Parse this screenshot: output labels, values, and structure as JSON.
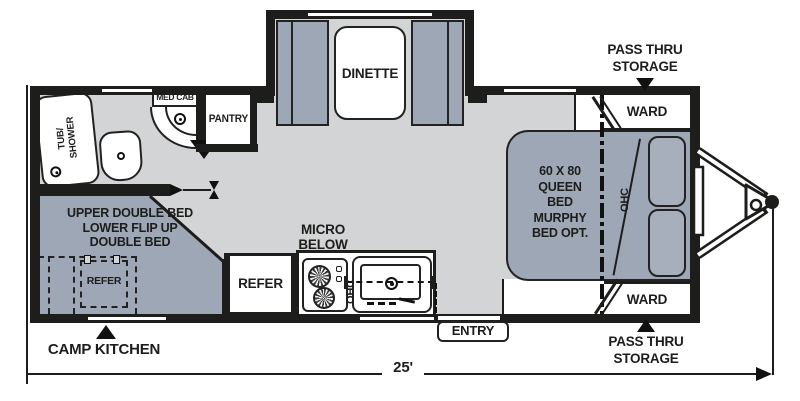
{
  "colors": {
    "wall": "#1d1d1b",
    "floor": "#d3d4d5",
    "furniture": "#9ea7b6",
    "pillow": "#a7afbd",
    "background": "#ffffff"
  },
  "plan": {
    "length_dimension": "25'",
    "slide_out": {
      "dinette": "DINETTE"
    },
    "bathroom": {
      "tub": "TUB/\nSHOWER",
      "med_cab": "MED CAB",
      "pantry": "PANTRY"
    },
    "rear_bed": {
      "text": "UPPER DOUBLE BED\nLOWER FLIP UP\nDOUBLE BED",
      "refer": "REFER",
      "camp_kitchen": "CAMP KITCHEN"
    },
    "galley": {
      "micro": "MICRO\nBELOW",
      "refer": "REFER",
      "ohc": "OHC"
    },
    "bedroom": {
      "bed": "60 X 80\nQUEEN\nBED\nMURPHY\nBED OPT.",
      "ohc": "OHC",
      "ward_top": "WARD",
      "ward_bottom": "WARD"
    },
    "exterior": {
      "pass_thru_top": "PASS THRU\nSTORAGE",
      "pass_thru_bottom": "PASS THRU\nSTORAGE",
      "entry": "ENTRY"
    }
  }
}
